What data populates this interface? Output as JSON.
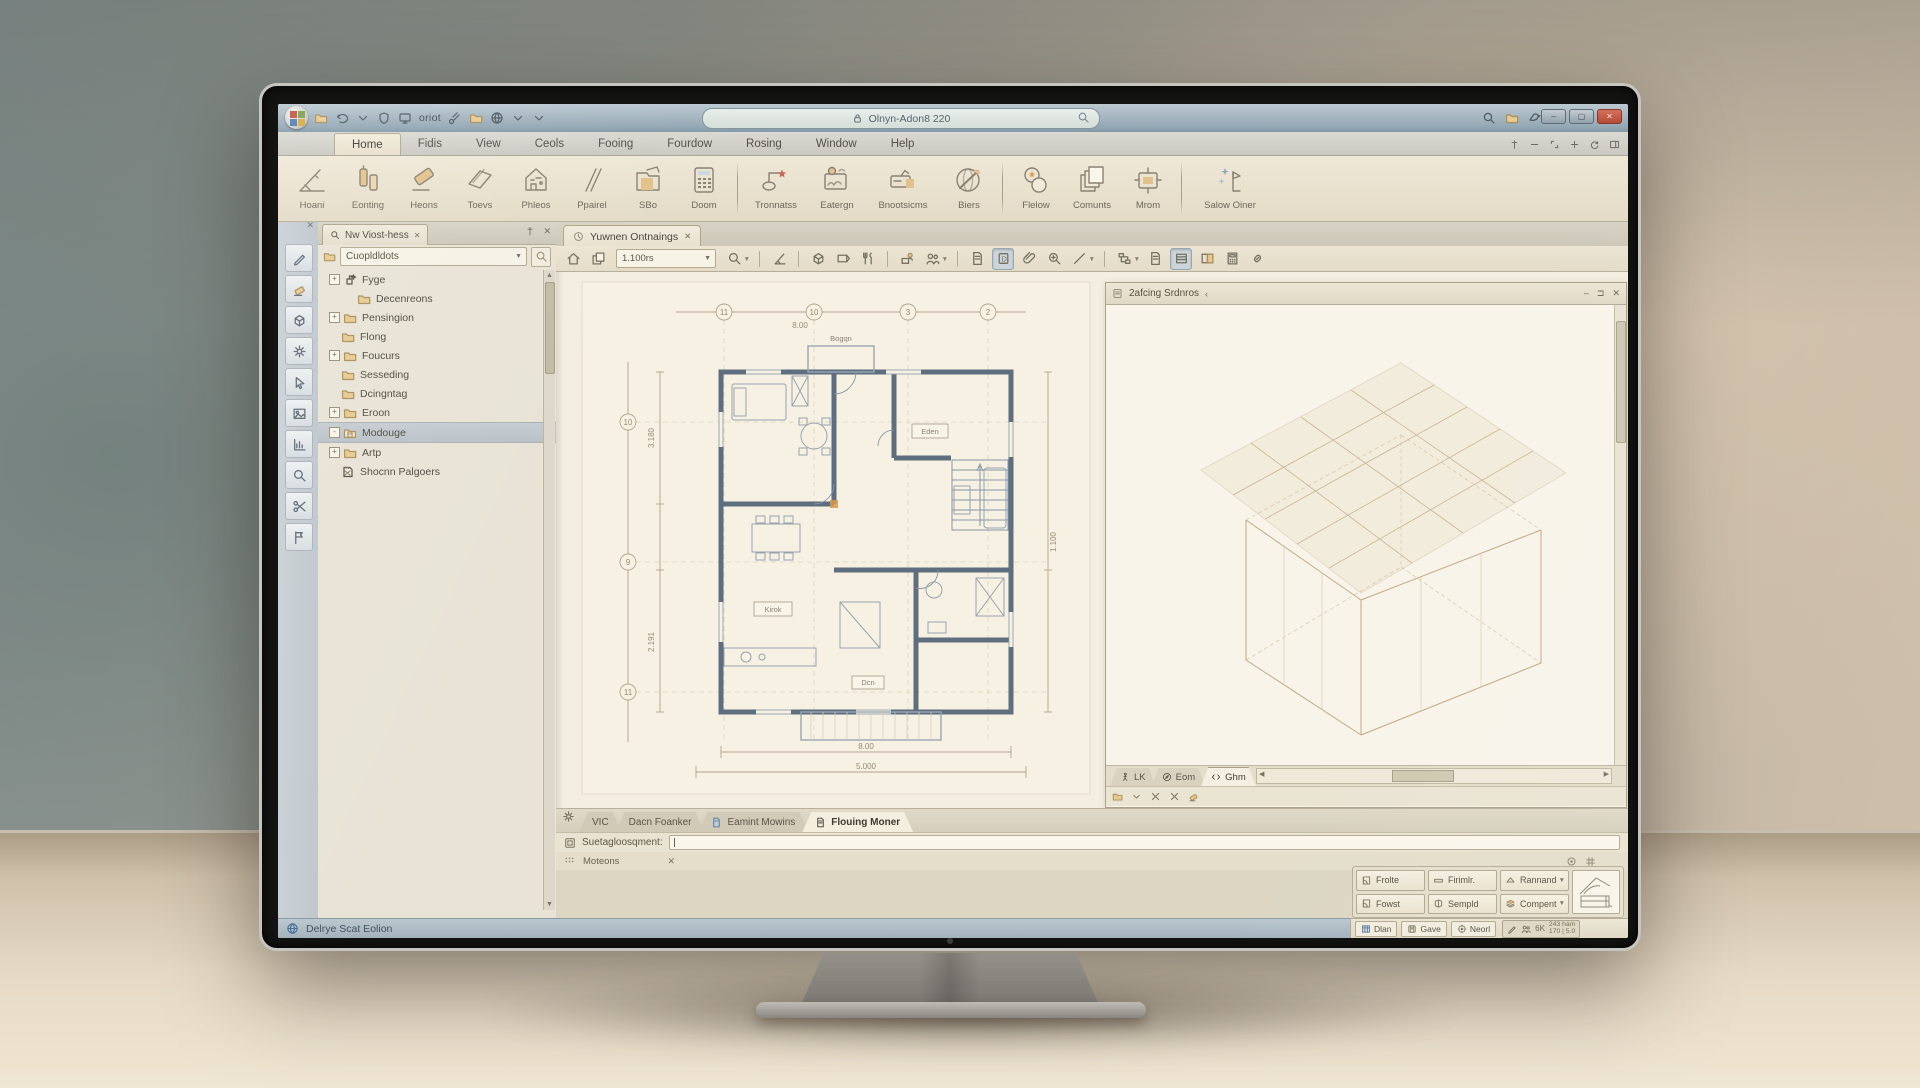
{
  "chrome": {
    "left_icons": [
      "folder-icon",
      "undo-icon",
      "chevron-down-icon",
      "shield-icon",
      "monitor-icon"
    ],
    "quick_text": "oriot",
    "mid_icons": [
      "spray-icon",
      "folder-icon",
      "globe-icon",
      "chevron-down-icon",
      "chevron-down-icon"
    ],
    "address_value": "Olnyn-Adon8 220",
    "right_icons": [
      "magnifier-icon",
      "folder-icon",
      "bird-icon"
    ],
    "window_buttons": [
      {
        "name": "minimize-button",
        "glyph": "–"
      },
      {
        "name": "maximize-button",
        "glyph": "▢"
      },
      {
        "name": "close-button",
        "glyph": "✕"
      }
    ]
  },
  "menu": {
    "items": [
      "Home",
      "Fidis",
      "View",
      "Ceols",
      "Fooing",
      "Fourdow",
      "Rosing",
      "Window",
      "Help"
    ],
    "active_index": 0,
    "right_icons": [
      "pin-icon",
      "minus-icon",
      "expand-icon",
      "plus-icon",
      "refresh-icon",
      "dock-icon"
    ]
  },
  "ribbon": {
    "groups": [
      {
        "buttons": [
          {
            "label": "Hoani",
            "icon": "ruler-compass-icon"
          },
          {
            "label": "Eonting",
            "icon": "columns-icon"
          },
          {
            "label": "Heons",
            "icon": "eraser-big-icon"
          },
          {
            "label": "Toevs",
            "icon": "beam-icon"
          },
          {
            "label": "Phleos",
            "icon": "house-plan-icon"
          },
          {
            "label": "Ppairel",
            "icon": "lines-icon"
          },
          {
            "label": "SBo",
            "icon": "folder-book-icon"
          },
          {
            "label": "Doom",
            "icon": "calc-grid-icon"
          }
        ]
      },
      {
        "buttons": [
          {
            "label": "Tronnatss",
            "icon": "node-link-icon",
            "wide": "w64"
          },
          {
            "label": "Eatergn",
            "icon": "picture-icon"
          },
          {
            "label": "Bnootsicms",
            "icon": "callout-icon",
            "wide": "w74"
          },
          {
            "label": "Biers",
            "icon": "globe-pen-icon"
          }
        ]
      },
      {
        "buttons": [
          {
            "label": "Flelow",
            "icon": "circles-icon"
          },
          {
            "label": "Comunts",
            "icon": "layers3-icon"
          },
          {
            "label": "Mrom",
            "icon": "plug-icon"
          }
        ]
      },
      {
        "buttons": [
          {
            "label": "Salow Oiner",
            "icon": "sparkle-flag-icon",
            "wide": "w84"
          }
        ]
      }
    ]
  },
  "tool_strip": [
    "pen-icon",
    "eraser-icon",
    "box3d-icon",
    "gear-icon",
    "cursor-icon",
    "image-icon",
    "chart-icon",
    "magnifier-icon",
    "scissors-icon",
    "flag-icon"
  ],
  "left_panel": {
    "tab_label": "Nw Viost-hess",
    "combo_value": "Cuopldldots",
    "tree": [
      {
        "label": "Fyge",
        "depth": 0,
        "expander": "+",
        "icon": "node-icon"
      },
      {
        "label": "Decenreons",
        "depth": 1,
        "expander": "",
        "icon": "folder-icon"
      },
      {
        "label": "Pensingion",
        "depth": 0,
        "expander": "+",
        "icon": "folder-icon"
      },
      {
        "label": "Flong",
        "depth": 0,
        "expander": "",
        "icon": "folder-icon"
      },
      {
        "label": "Foucurs",
        "depth": 0,
        "expander": "+",
        "icon": "folder-icon"
      },
      {
        "label": "Sesseding",
        "depth": 0,
        "expander": "",
        "icon": "folder-icon"
      },
      {
        "label": "Dcingntag",
        "depth": 0,
        "expander": "",
        "icon": "folder-icon"
      },
      {
        "label": "Eroon",
        "depth": 0,
        "expander": "+",
        "icon": "folder-icon"
      },
      {
        "label": "Modouge",
        "depth": 0,
        "expander": "-",
        "icon": "folder-doc-icon",
        "selected": true
      },
      {
        "label": "Artp",
        "depth": 0,
        "expander": "+",
        "icon": "folder-icon"
      },
      {
        "label": "Shocnn Palgoers",
        "depth": 0,
        "expander": "",
        "icon": "sketch-icon"
      }
    ]
  },
  "document": {
    "tab_label": "Yuwnen Ontnaings",
    "scale_value": "1.100rs"
  },
  "doc_toolbar": {
    "items": [
      {
        "t": "i",
        "n": "home-icon"
      },
      {
        "t": "i",
        "n": "layers-icon"
      },
      {
        "t": "combo"
      },
      {
        "t": "i",
        "n": "magnifier-icon",
        "dd": 1
      },
      {
        "t": "s"
      },
      {
        "t": "i",
        "n": "ruler-icon"
      },
      {
        "t": "s"
      },
      {
        "t": "i",
        "n": "box3d-icon"
      },
      {
        "t": "i",
        "n": "label-icon"
      },
      {
        "t": "i",
        "n": "tools-icon"
      },
      {
        "t": "s"
      },
      {
        "t": "i",
        "n": "plot-icon"
      },
      {
        "t": "i",
        "n": "people-icon",
        "dd": 1
      },
      {
        "t": "s"
      },
      {
        "t": "i",
        "n": "doc-icon"
      },
      {
        "t": "i",
        "n": "marker-icon",
        "pressed": 1
      },
      {
        "t": "i",
        "n": "clip-icon"
      },
      {
        "t": "i",
        "n": "zoom-icon"
      },
      {
        "t": "i",
        "n": "line-icon",
        "dd": 1
      },
      {
        "t": "s"
      },
      {
        "t": "i",
        "n": "flow-icon",
        "dd": 1
      },
      {
        "t": "i",
        "n": "doc-icon"
      },
      {
        "t": "i",
        "n": "ruled-icon",
        "pressed": 1
      },
      {
        "t": "i",
        "n": "split-icon"
      },
      {
        "t": "i",
        "n": "calc-icon"
      },
      {
        "t": "i",
        "n": "link-icon"
      }
    ]
  },
  "plan": {
    "grid_top": [
      "11",
      "10",
      "3",
      "2"
    ],
    "grid_left": [
      "10",
      "9",
      "11"
    ],
    "room_labels": {
      "top": "Bogqn",
      "right": "Eden",
      "kitchen": "Kirok",
      "bottom": "Dcn"
    },
    "dims": {
      "top": "8.00",
      "bottom1": "8.00",
      "bottom2": "5.000",
      "left1": "3.180",
      "left2": "2.191",
      "right1": "1.100"
    }
  },
  "right_window": {
    "title": "2afcing Srdnros",
    "back_glyph": "‹",
    "header_buttons": [
      {
        "name": "minimize-window-button",
        "glyph": "–"
      },
      {
        "name": "pin-window-button",
        "glyph": "⊐"
      },
      {
        "name": "close-window-button",
        "glyph": "✕"
      }
    ],
    "tabs": [
      {
        "label": "LK",
        "icon": "walk-icon"
      },
      {
        "label": "Eom",
        "icon": "compass-icon"
      },
      {
        "label": "Ghm",
        "icon": "code-icon",
        "active": true
      }
    ],
    "icon_row": [
      "folder-icon",
      "chevron-down-icon",
      "close-icon",
      "close-icon",
      "eraser-icon"
    ]
  },
  "bottom_tabs": {
    "tabs": [
      {
        "label": "VIC",
        "icon": ""
      },
      {
        "label": "Dacn Foanker",
        "icon": ""
      },
      {
        "label": "Eamint Mowins",
        "icon": "doc-blue-icon"
      },
      {
        "label": "Flouing Moner",
        "icon": "doc-icon",
        "active": true
      }
    ]
  },
  "command_row": {
    "label": "Suetagloosqment:"
  },
  "options_row": {
    "label": "Moteons"
  },
  "quick_panel": {
    "rows": [
      [
        {
          "label": "Frolte",
          "icon": "door-icon"
        },
        {
          "label": "Firimlr.",
          "icon": "slab-icon"
        },
        {
          "label": "Rannand",
          "icon": "roof-icon",
          "dropdown": true
        }
      ],
      [
        {
          "label": "Fowst",
          "icon": "door-icon"
        },
        {
          "label": "Sempld",
          "icon": "shell-icon"
        },
        {
          "label": "Compent",
          "icon": "stack-icon",
          "dropdown": true
        }
      ]
    ]
  },
  "status_bar": {
    "left_text": "Delrye Scat Eolion",
    "buttons": [
      {
        "label": "Dlan",
        "icon": "table-icon"
      },
      {
        "label": "Gave",
        "icon": "save-icon"
      },
      {
        "label": "Neorl",
        "icon": "target-icon"
      }
    ],
    "meter_label": "6K",
    "info_line1": "243 hám",
    "info_line2": "170 | 5.0"
  }
}
